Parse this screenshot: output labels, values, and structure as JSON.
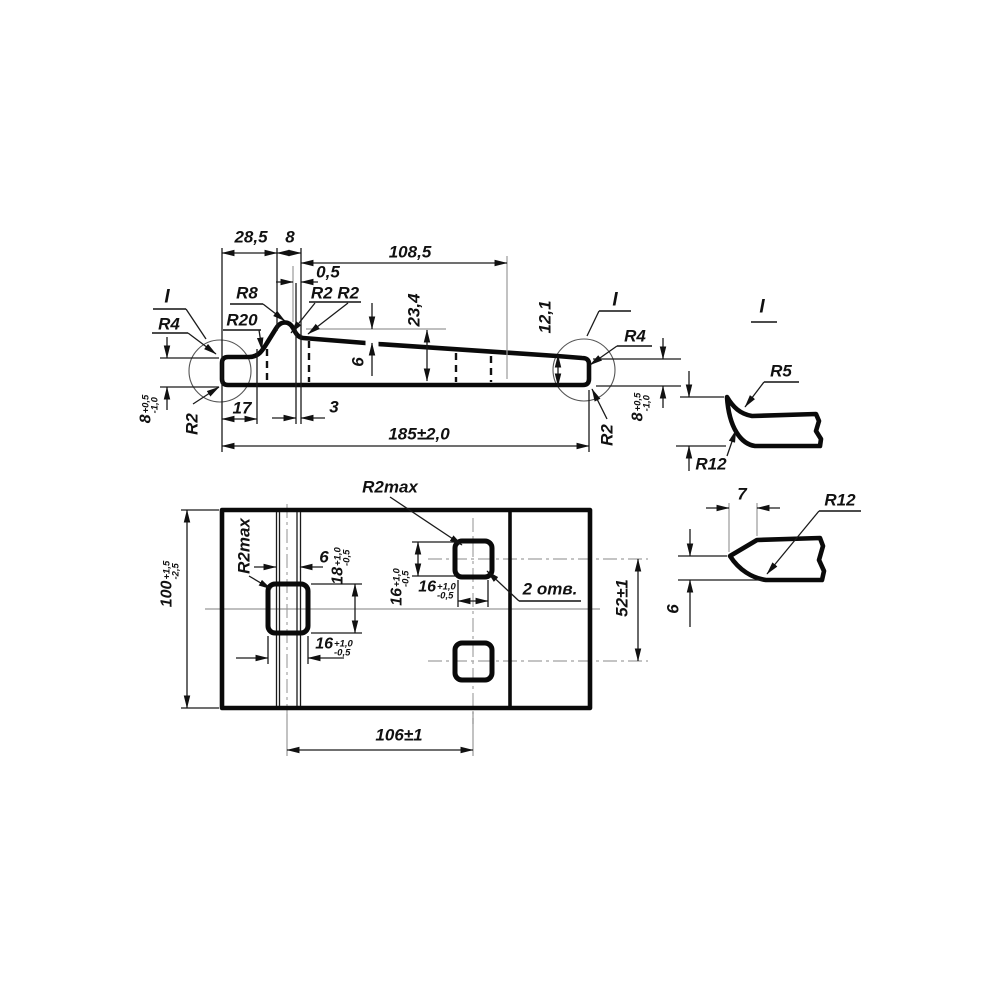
{
  "drawing": {
    "background": "#ffffff",
    "line_color": "#0a0a0a",
    "centerline_color": "#b0b0b0",
    "side_view": {
      "dims": {
        "d28_5": "28,5",
        "d8": "8",
        "d108_5": "108,5",
        "d0_5": "0,5",
        "d23_4": "23,4",
        "d6": "6",
        "d12_1": "12,1",
        "d17": "17",
        "d3": "3",
        "d185": "185±2,0"
      },
      "radii": {
        "r4_left": "R4",
        "r8": "R8",
        "r20": "R20",
        "r2r2": "R2 R2",
        "r2_left": "R2",
        "r4_right": "R4",
        "r2_right": "R2"
      },
      "detail_refs": {
        "left": "I",
        "right": "I"
      },
      "thickness_left": {
        "value": "8",
        "upper": "+0,5",
        "lower": "-1,0"
      },
      "thickness_right": {
        "value": "8",
        "upper": "+0,5",
        "lower": "-1,0"
      }
    },
    "plan_view": {
      "dims": {
        "d100": {
          "value": "100",
          "upper": "+1,5",
          "lower": "-2,5"
        },
        "d106": "106±1",
        "d52": "52±1",
        "d6": "6",
        "d18": {
          "value": "18",
          "upper": "+1,0",
          "lower": "-0,5"
        },
        "d16_v": {
          "value": "16",
          "upper": "+1,0",
          "lower": "-0,5"
        },
        "d16_top": {
          "value": "16",
          "upper": "+1,0",
          "lower": "-0,5"
        },
        "d16_mid": {
          "value": "16",
          "upper": "+1,0",
          "lower": "-0,5"
        }
      },
      "notes": {
        "r2max_top": "R2max",
        "r2max_left": "R2max",
        "holes": "2 отв."
      }
    },
    "detail_view": {
      "title": "I",
      "r5": "R5",
      "r12": "R12"
    },
    "tip_view": {
      "d7": "7",
      "r12": "R12",
      "d6": "6"
    }
  }
}
